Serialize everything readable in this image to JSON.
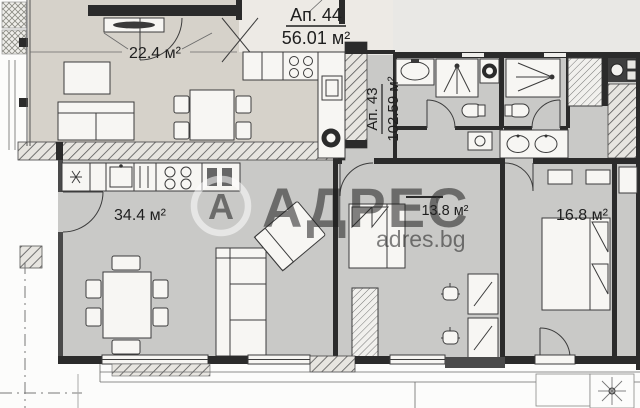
{
  "apartments": {
    "apt44": {
      "name": "Ап. 44",
      "area": "56.01 м²",
      "room_area": "22.4 м²"
    },
    "apt43": {
      "name": "Ап. 43",
      "area": "102.59 м²",
      "living_area": "34.4 м²",
      "bedroom_small_area": "13.8 м²",
      "bedroom_large_area": "16.8 м²"
    }
  },
  "watermark": {
    "logo_letter": "А",
    "brand": "АДРЕС",
    "website": "adres.bg"
  },
  "colors": {
    "room_warm": "#d6d2ca",
    "room_cool": "#c9c9c7",
    "outside": "#e9e8e5",
    "label_bg": "#edeae5",
    "wall": "#2b2b2b",
    "watermark_white": "#ffffff"
  }
}
